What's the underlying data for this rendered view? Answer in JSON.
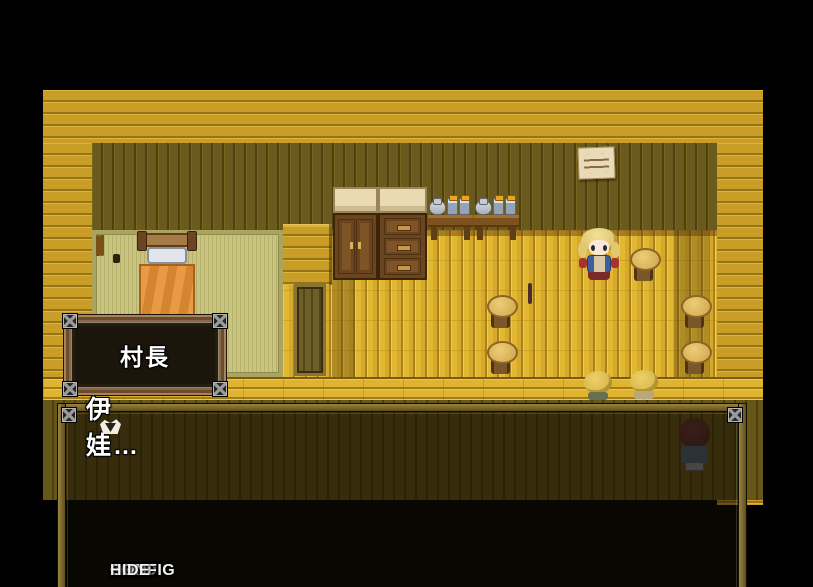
{
  "name_box": {
    "label": "村長"
  },
  "dialogue": {
    "text": "伊娃…",
    "cursor_icon": "next-page-cursor-icon"
  },
  "menu": {
    "items": [
      {
        "label": "AUTO",
        "enabled": true
      },
      {
        "label": "FAST",
        "enabled": true
      },
      {
        "label": "LOG",
        "enabled": true
      },
      {
        "label": "LOAD",
        "enabled": false
      },
      {
        "label": "CONFIG",
        "enabled": true
      },
      {
        "label": "HIDE",
        "enabled": true
      }
    ]
  },
  "palette": {
    "wall-gold": "#c99d26",
    "backwall": "#6b5a1d",
    "floor": "#e2b832",
    "tatami": "#c9c47e",
    "table-top": "#744242",
    "table-base": "#201718",
    "stool": "#cfa448",
    "blanket": "#e89a44",
    "menu-text": "#f2f2f2",
    "menu-disabled": "#8e8e8e"
  }
}
